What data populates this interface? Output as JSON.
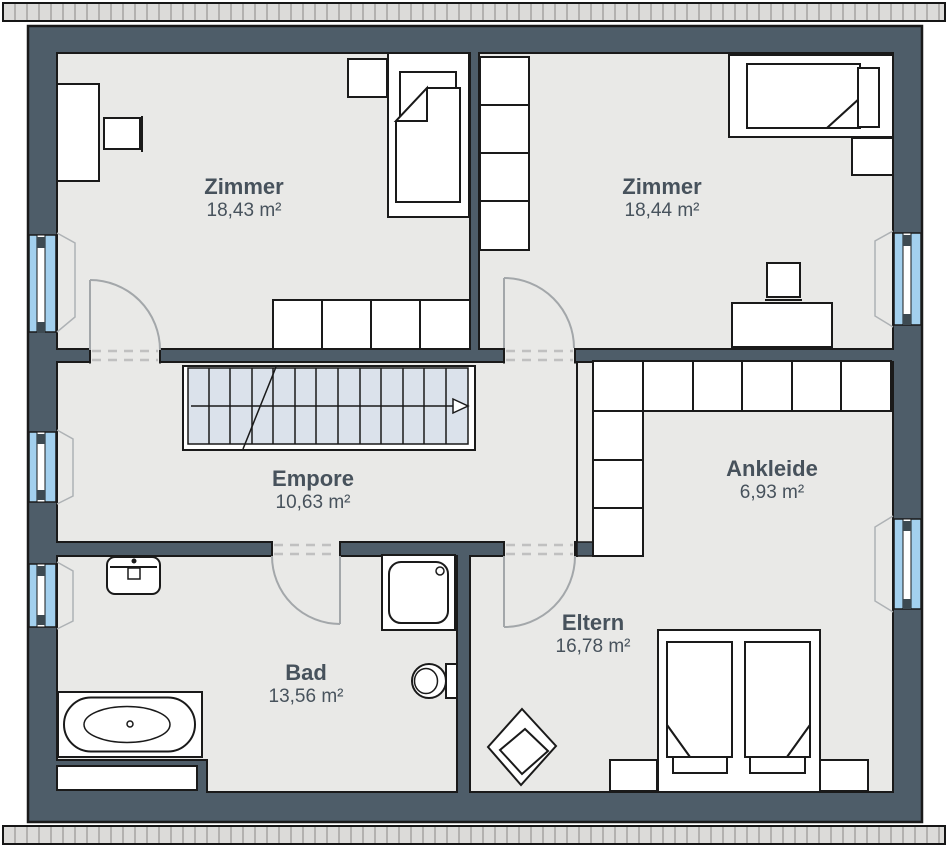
{
  "plan_title": "Dachgeschoss Grundriss",
  "rooms": [
    {
      "key": "zimmer_left",
      "name": "Zimmer",
      "area": "18,43 m²"
    },
    {
      "key": "zimmer_right",
      "name": "Zimmer",
      "area": "18,44 m²"
    },
    {
      "key": "empore",
      "name": "Empore",
      "area": "10,63 m²"
    },
    {
      "key": "ankleide",
      "name": "Ankleide",
      "area": "6,93 m²"
    },
    {
      "key": "bad",
      "name": "Bad",
      "area": "13,56 m²"
    },
    {
      "key": "eltern",
      "name": "Eltern",
      "area": "16,78 m²"
    }
  ],
  "colors": {
    "wall": "#4e5d69",
    "floor": "#e9e9e7",
    "window_glass": "#a3d0ee",
    "stairs_fill": "#dbe2eb",
    "furniture_fill": "#ffffff",
    "line": "#1a1a1a",
    "door_swing": "#a3a7aa",
    "threshold_dash": "#c0c0c0",
    "label_text": "#47525c",
    "roof_hatch": "#dcdbd9"
  }
}
